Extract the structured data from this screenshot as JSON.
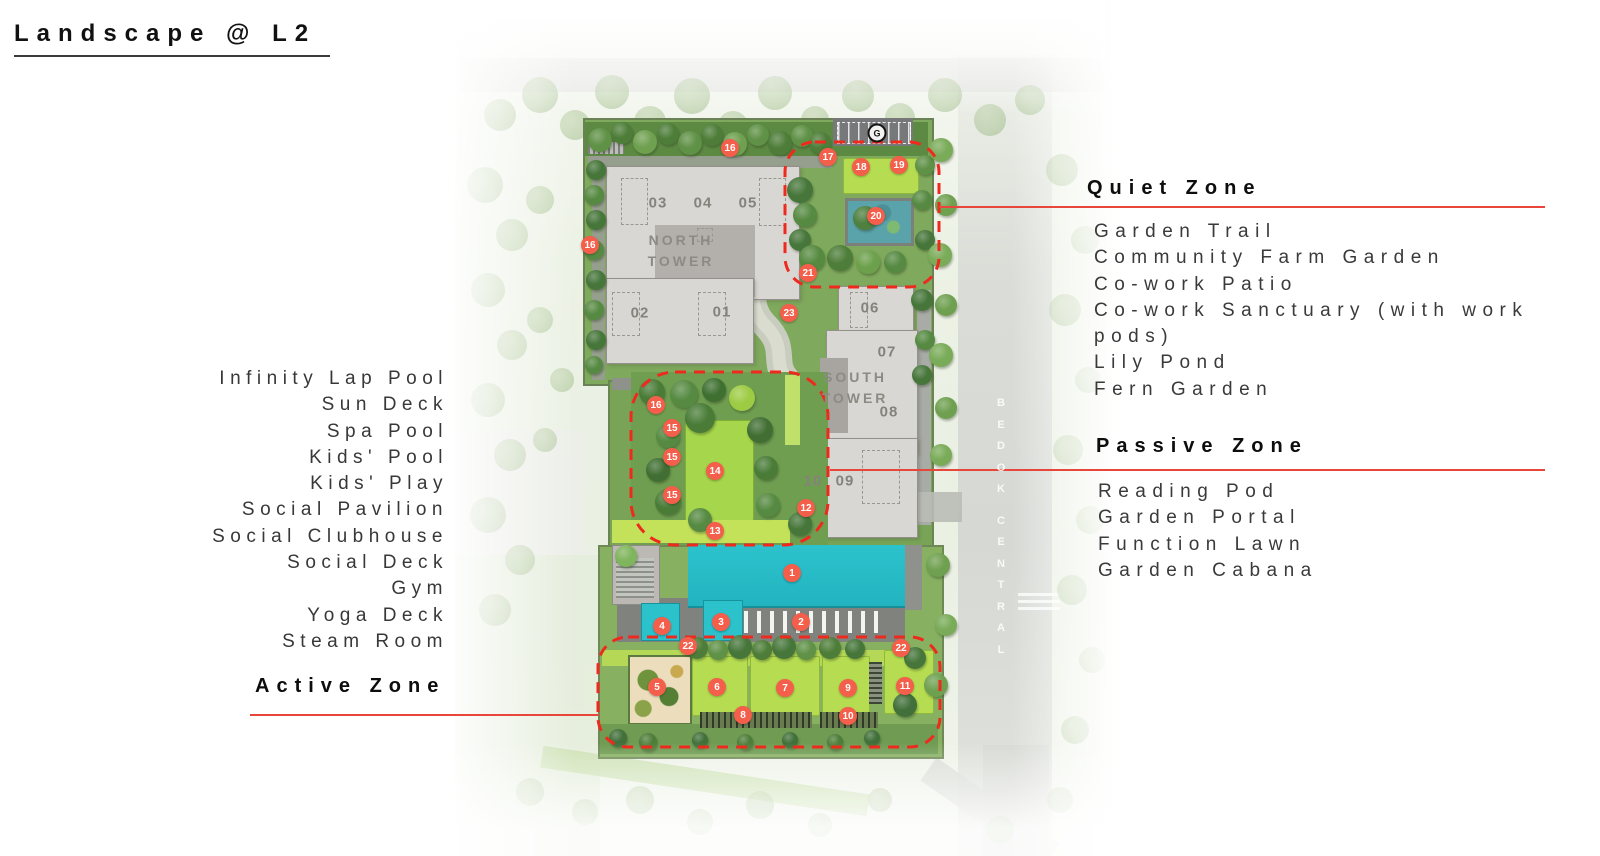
{
  "title": "Landscape @ L2",
  "zones": {
    "active": {
      "label": "Active Zone",
      "items": [
        "Infinity Lap Pool",
        "Sun Deck",
        "Spa Pool",
        "Kids' Pool",
        "Kids' Play",
        "Social Pavilion",
        "Social Clubhouse",
        "Social Deck",
        "Gym",
        "Yoga Deck",
        "Steam Room"
      ]
    },
    "quiet": {
      "label": "Quiet Zone",
      "items": [
        "Garden Trail",
        "Community Farm Garden",
        "Co-work Patio",
        "Co-work Sanctuary (with work pods)",
        "Lily Pond",
        "Fern Garden"
      ]
    },
    "passive": {
      "label": "Passive Zone",
      "items": [
        "Reading Pod",
        "Garden Portal",
        "Function Lawn",
        "Garden Cabana"
      ]
    }
  },
  "map": {
    "gate_label": "G",
    "road_label": "BEDOK CENTRAL",
    "towers": [
      {
        "name": "NORTH TOWER",
        "x": 681,
        "y": 251
      },
      {
        "name": "SOUTH TOWER",
        "x": 855,
        "y": 388
      }
    ],
    "unit_labels": [
      {
        "t": "03",
        "x": 658,
        "y": 203
      },
      {
        "t": "04",
        "x": 703,
        "y": 203
      },
      {
        "t": "05",
        "x": 748,
        "y": 203
      },
      {
        "t": "02",
        "x": 640,
        "y": 313
      },
      {
        "t": "01",
        "x": 722,
        "y": 312
      },
      {
        "t": "06",
        "x": 870,
        "y": 308
      },
      {
        "t": "07",
        "x": 887,
        "y": 352
      },
      {
        "t": "08",
        "x": 889,
        "y": 412
      },
      {
        "t": "10",
        "x": 813,
        "y": 481
      },
      {
        "t": "09",
        "x": 845,
        "y": 481
      }
    ],
    "markers": [
      {
        "n": "1",
        "x": 792,
        "y": 573
      },
      {
        "n": "2",
        "x": 801,
        "y": 622
      },
      {
        "n": "3",
        "x": 721,
        "y": 622
      },
      {
        "n": "4",
        "x": 662,
        "y": 626
      },
      {
        "n": "5",
        "x": 657,
        "y": 687
      },
      {
        "n": "6",
        "x": 717,
        "y": 687
      },
      {
        "n": "7",
        "x": 785,
        "y": 688
      },
      {
        "n": "8",
        "x": 743,
        "y": 715
      },
      {
        "n": "9",
        "x": 848,
        "y": 688
      },
      {
        "n": "10",
        "x": 848,
        "y": 716
      },
      {
        "n": "11",
        "x": 905,
        "y": 686
      },
      {
        "n": "12",
        "x": 806,
        "y": 508
      },
      {
        "n": "13",
        "x": 715,
        "y": 531
      },
      {
        "n": "14",
        "x": 715,
        "y": 471
      },
      {
        "n": "15",
        "x": 672,
        "y": 428
      },
      {
        "n": "15",
        "x": 672,
        "y": 457
      },
      {
        "n": "15",
        "x": 672,
        "y": 495
      },
      {
        "n": "16",
        "x": 730,
        "y": 148
      },
      {
        "n": "16",
        "x": 590,
        "y": 245
      },
      {
        "n": "16",
        "x": 656,
        "y": 405
      },
      {
        "n": "17",
        "x": 828,
        "y": 157
      },
      {
        "n": "18",
        "x": 861,
        "y": 167
      },
      {
        "n": "19",
        "x": 899,
        "y": 165
      },
      {
        "n": "20",
        "x": 876,
        "y": 216
      },
      {
        "n": "21",
        "x": 808,
        "y": 273
      },
      {
        "n": "22",
        "x": 688,
        "y": 646
      },
      {
        "n": "22",
        "x": 901,
        "y": 648
      },
      {
        "n": "23",
        "x": 789,
        "y": 313
      }
    ],
    "colors": {
      "marker": "#f45f4b",
      "zone_dash": "#ee2a1e",
      "connector_line": "#e8453b",
      "pool": "#27bdc8",
      "bright_lawn": "#b6dd51",
      "building": "#d9d7d3"
    }
  }
}
